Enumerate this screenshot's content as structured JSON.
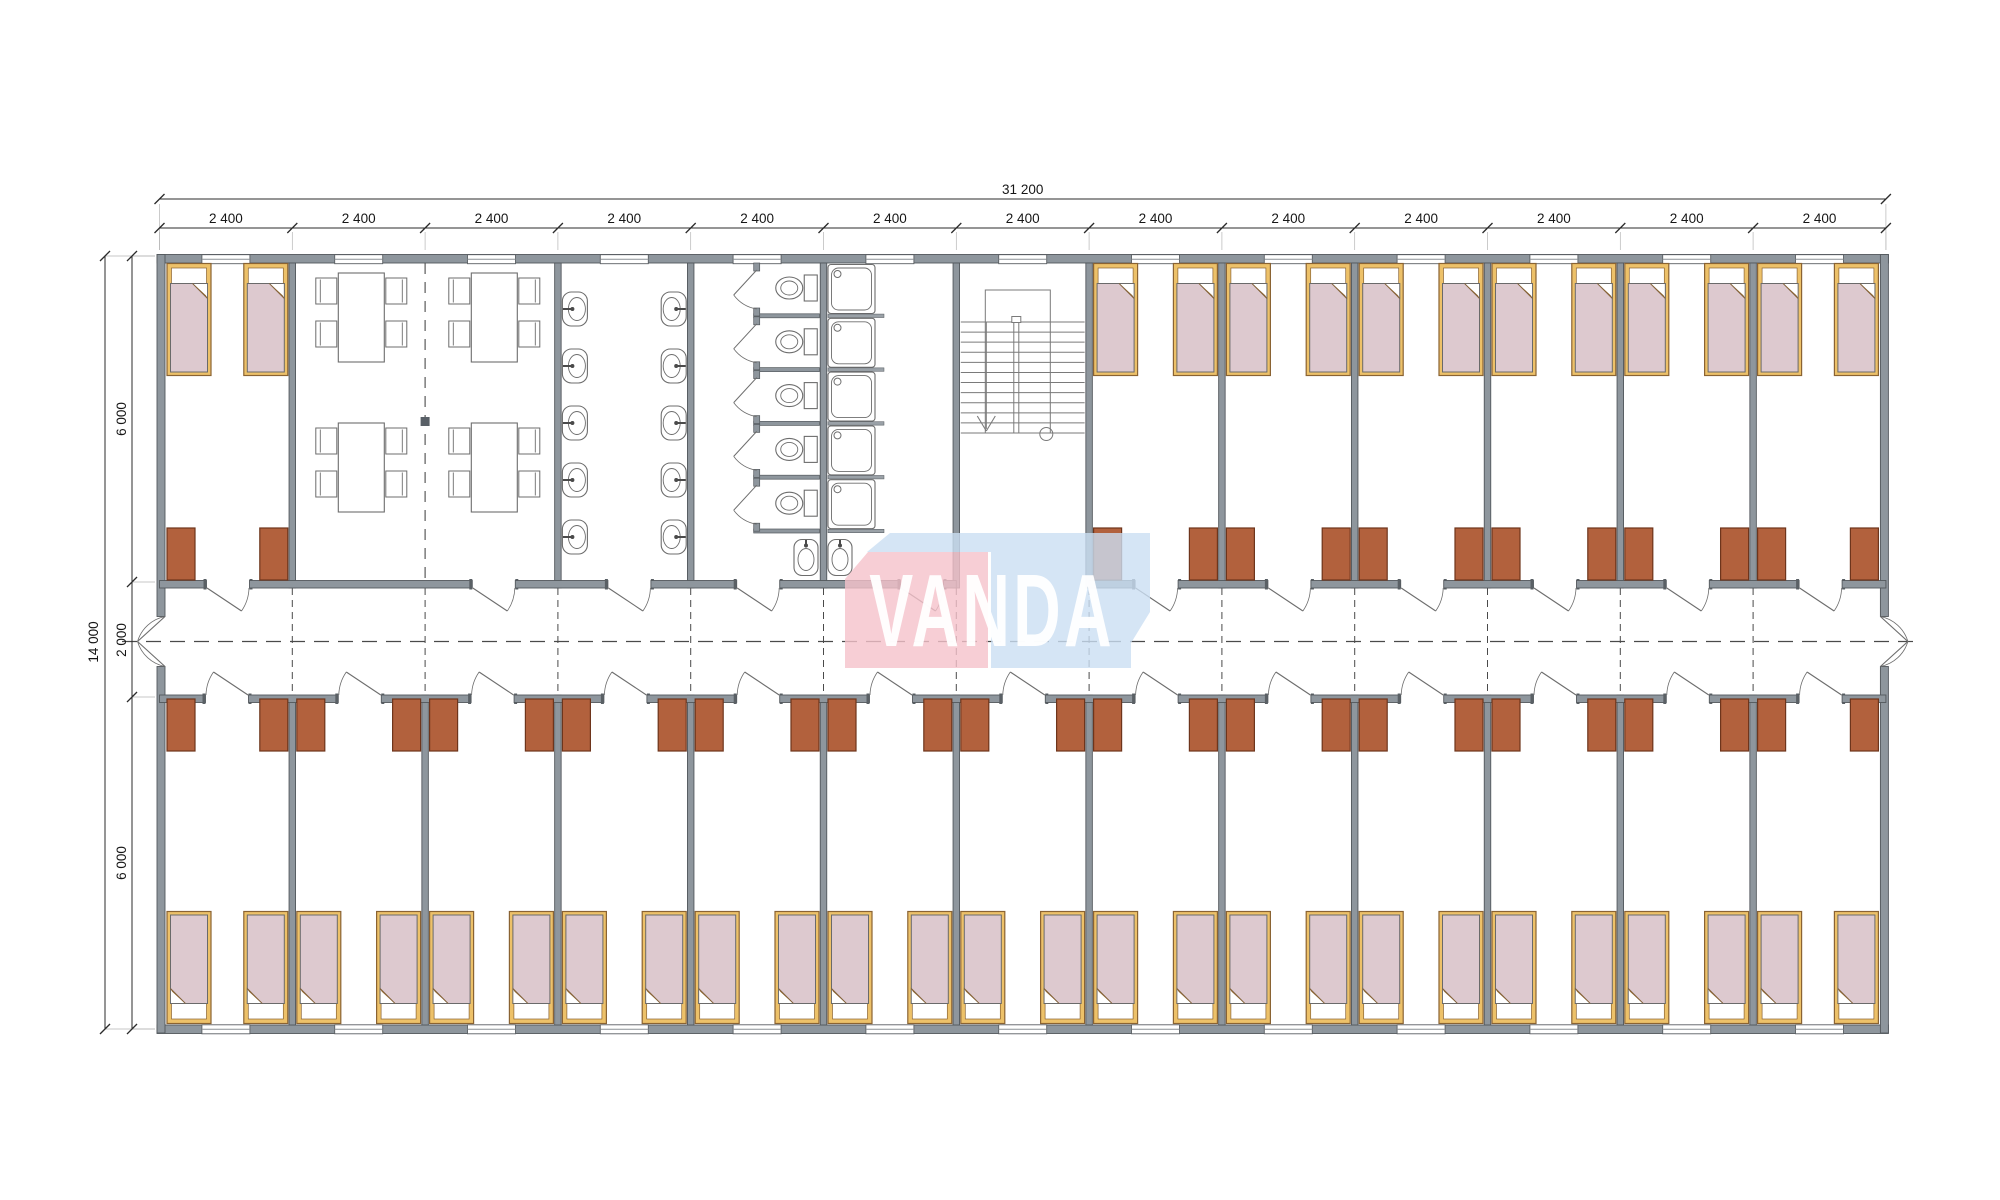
{
  "logo": {
    "text": "VANDA",
    "pink_color": "#f5c2ca",
    "blue_color": "#cadef2"
  },
  "dimensions": {
    "total_width": "31 200",
    "module_width": "2 400",
    "module_count": 13,
    "total_height": "14 000",
    "upper_rooms_depth": "6 000",
    "corridor_width": "2 000",
    "lower_rooms_depth": "6 000"
  },
  "palette": {
    "wall_fill": "#8e969d",
    "wall_edge": "#53585d",
    "cap_fill": "#5a6065",
    "furniture_line": "#6d6d6d",
    "stair_line": "#7a7a7a",
    "dash_line": "#4a4a4a",
    "dim_line": "#2b2b2b",
    "dim_text": "#161616",
    "bed_frame": "#edc169",
    "bed_frame_edge": "#8a6333",
    "blanket_fill": "#ddc9cf",
    "blanket_edge": "#6a6a6a",
    "wardrobe_fill": "#b2613d",
    "wardrobe_edge": "#6e351c",
    "grid_square": "#596067"
  },
  "layout": {
    "top_rooms": [
      {
        "type": "bedroom",
        "span": 1,
        "beds": 2,
        "wardrobes": 2,
        "door_offset": 47
      },
      {
        "type": "dining",
        "span": 2,
        "tables": 4,
        "chairs_per_table": 4,
        "door_offset": 180
      },
      {
        "type": "washroom",
        "span": 1,
        "sinks": 10,
        "door_offset": 50
      },
      {
        "type": "toilet-room",
        "span": 1,
        "stalls": 5,
        "sinks": 1,
        "door_offset": 46
      },
      {
        "type": "shower-room",
        "span": 1,
        "showers": 5,
        "sinks": 1,
        "door_offset": 77
      },
      {
        "type": "stair-hall",
        "span": 1,
        "stair_treads": 12
      },
      {
        "type": "bedroom",
        "span": 1,
        "beds": 2,
        "wardrobes": 2,
        "door_offset": 46
      },
      {
        "type": "bedroom",
        "span": 1,
        "beds": 2,
        "wardrobes": 2,
        "door_offset": 46
      },
      {
        "type": "bedroom",
        "span": 1,
        "beds": 2,
        "wardrobes": 2,
        "door_offset": 46
      },
      {
        "type": "bedroom",
        "span": 1,
        "beds": 2,
        "wardrobes": 2,
        "door_offset": 46
      },
      {
        "type": "bedroom",
        "span": 1,
        "beds": 2,
        "wardrobes": 2,
        "door_offset": 46
      },
      {
        "type": "bedroom",
        "span": 1,
        "beds": 2,
        "wardrobes": 2,
        "door_offset": 46
      }
    ],
    "bottom_rooms": {
      "type": "bedroom",
      "count": 13,
      "beds_each": 2,
      "wardrobes_each": 2,
      "door_offset": 46
    },
    "windows_top": 13,
    "windows_bottom": 13
  }
}
